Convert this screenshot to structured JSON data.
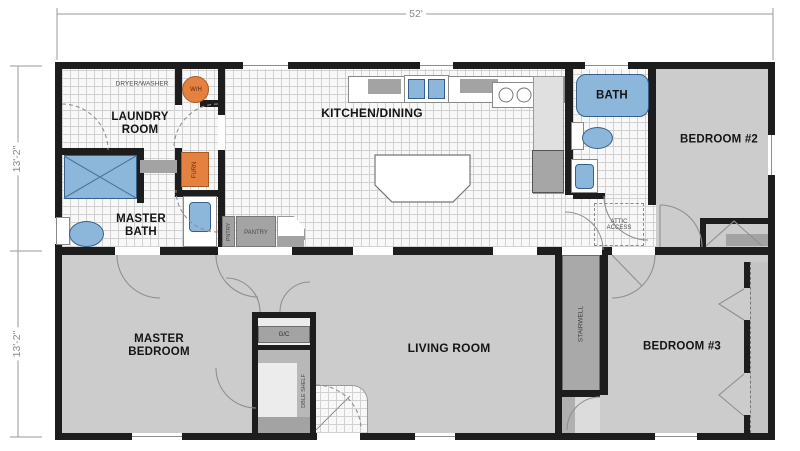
{
  "dimensions": {
    "width": "52'",
    "height_top": "13'-2\"",
    "height_bottom": "13'-2\""
  },
  "rooms": {
    "laundry": {
      "label": "LAUNDRY\nROOM"
    },
    "master_bath": {
      "label": "MASTER\nBATH"
    },
    "kitchen_dining": {
      "label": "KITCHEN/DINING"
    },
    "bath": {
      "label": "BATH"
    },
    "bedroom2": {
      "label": "BEDROOM #2"
    },
    "master_bedroom": {
      "label": "MASTER\nBEDROOM"
    },
    "living_room": {
      "label": "LIVING ROOM"
    },
    "bedroom3": {
      "label": "BEDROOM #3"
    }
  },
  "fixtures": {
    "dryer_washer": "DRYER/WASHER",
    "water_heater": "W/H",
    "furnace": "FURN",
    "pantry_cabinet": "PNTRY",
    "pantry": "PANTRY",
    "attic_access": "ATTIC\nACCESS",
    "garment_closet": "G/C",
    "double_shelf": "DBLE SHELF",
    "stairwell": "STAIRWELL"
  },
  "colors": {
    "wall": "#1d1d1d",
    "carpet": "#cccccc",
    "tile": "#f8f8f8",
    "fixture-blue": "#8cb6da",
    "appliance-orange": "#e58140",
    "cabinet-gray": "#a3a3a3",
    "stair-gray": "#a9a9a9",
    "line-gray": "#8f8f8f"
  }
}
